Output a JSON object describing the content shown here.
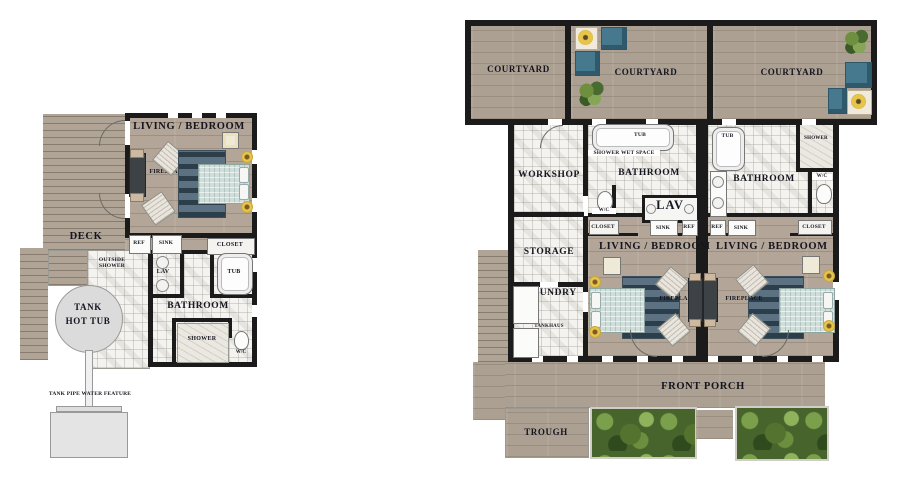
{
  "left_plan": {
    "living_bedroom": "LIVING / BEDROOM",
    "fireplace": "FIREPLACE",
    "deck": "DECK",
    "ref": "REF",
    "sink": "SINK",
    "closet": "CLOSET",
    "outside_shower": "OUTSIDE SHOWER",
    "lav": "LAV",
    "tub": "TUB",
    "bathroom": "BATHROOM",
    "shower": "SHOWER",
    "wc": "W/C",
    "tank_line1": "TANK",
    "tank_line2": "HOT TUB",
    "water_feature": "TANK PIPE WATER FEATURE"
  },
  "right_plan": {
    "courtyards": [
      "COURTYARD",
      "COURTYARD",
      "COURTYARD"
    ],
    "workshop": "WORKSHOP",
    "storage": "STORAGE",
    "laundry": "LAUNDRY",
    "tankhaus": "TANKHAUS",
    "front_porch": "FRONT PORCH",
    "trough": "TROUGH",
    "unit_left": {
      "tub": "TUB",
      "shower_wet_space": "SHOWER WET SPACE",
      "bathroom": "BATHROOM",
      "wc": "W/C",
      "lav": "LAV",
      "closet": "CLOSET",
      "sink": "SINK",
      "ref": "REF",
      "living_bedroom": "LIVING / BEDROOM",
      "fireplace": "FIREPLACE"
    },
    "unit_right": {
      "tub": "TUB",
      "shower": "SHOWER",
      "bathroom": "BATHROOM",
      "wc": "W/C",
      "ref": "REF",
      "sink": "SINK",
      "closet": "CLOSET",
      "living_bedroom": "LIVING / BEDROOM",
      "fireplace": "FIREPLACE"
    }
  },
  "palette": {
    "wall": "#1b1b1b",
    "wood": "#b3a698",
    "tile": "#f4f3ef",
    "label": "#15151f",
    "accent_yellow": "#e7c44c",
    "rug_blue": "#5c7282",
    "bed_quilt": "#cfdeda",
    "furniture_blue": "#47798e",
    "plant_green": "#54732f"
  }
}
